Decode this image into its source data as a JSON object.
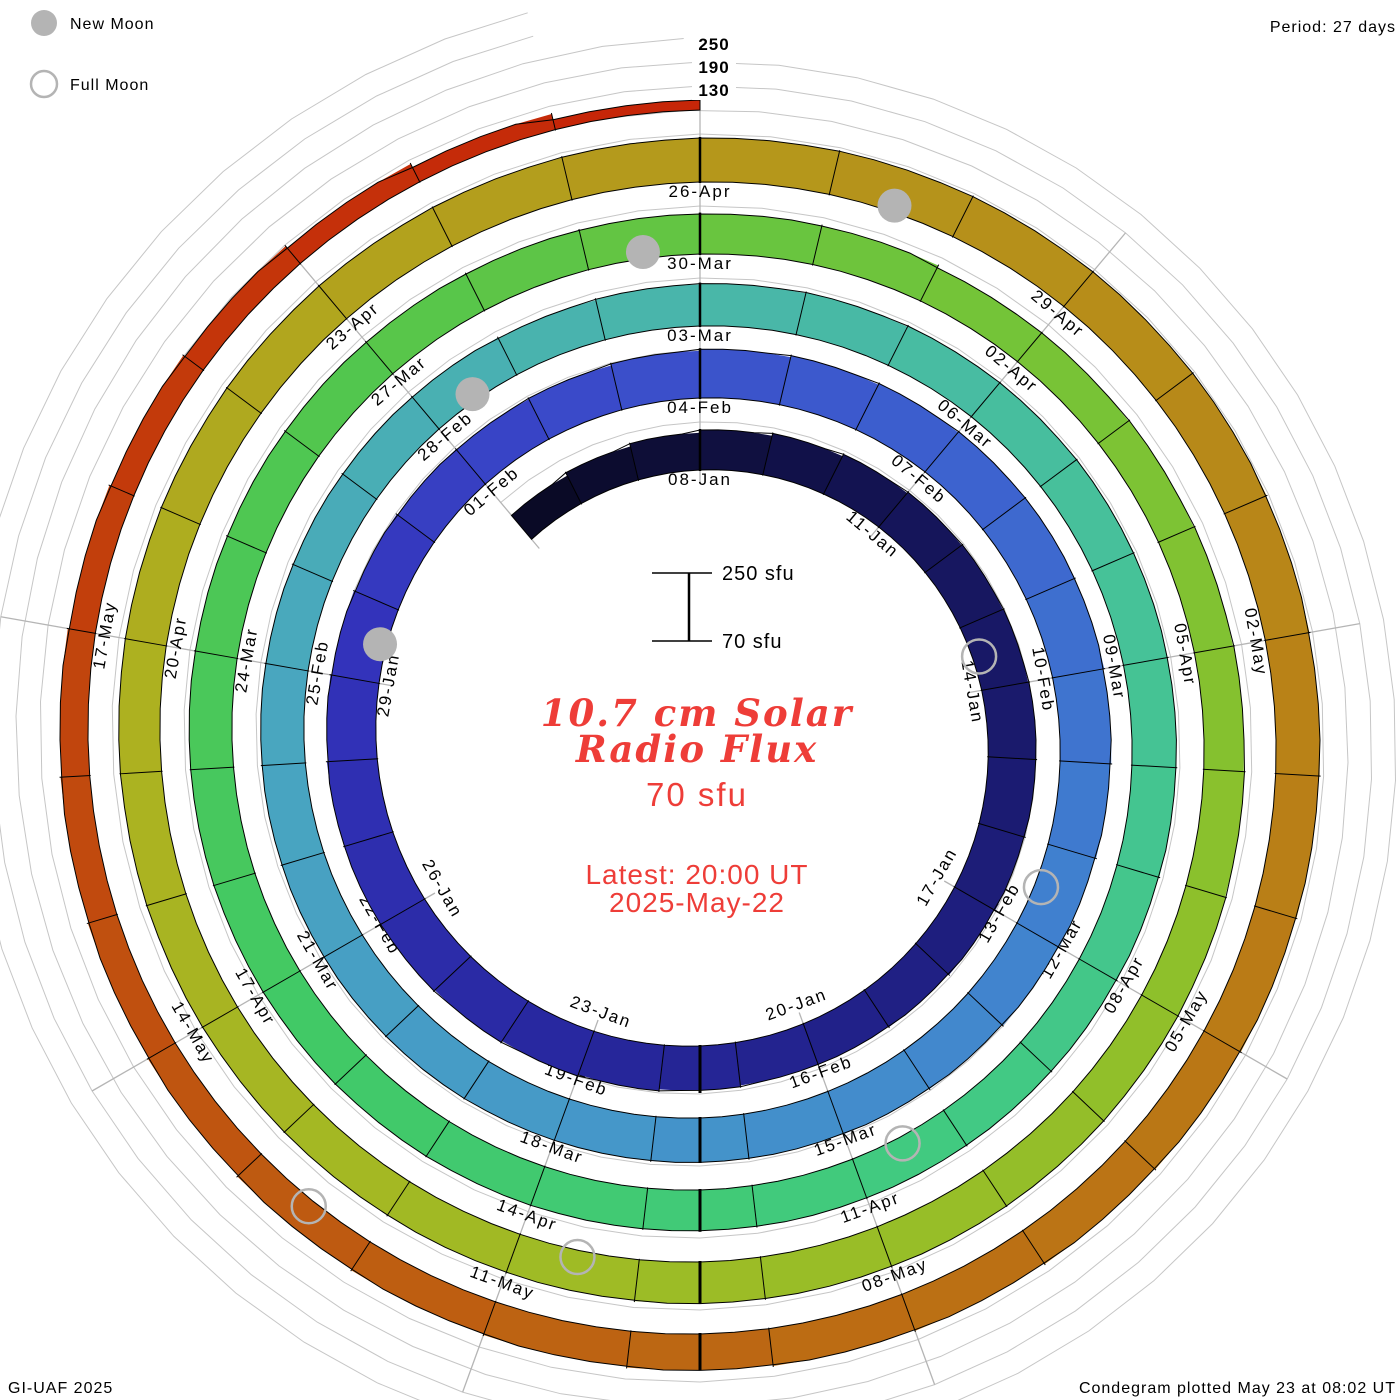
{
  "header": {
    "legend": [
      {
        "label": "New Moon",
        "type": "filled"
      },
      {
        "label": "Full Moon",
        "type": "open"
      }
    ],
    "period_label": "Period: 27 days"
  },
  "radial_axis": {
    "labels": [
      "250",
      "190",
      "130"
    ]
  },
  "center": {
    "scale_top": "250 sfu",
    "scale_bottom": "70 sfu",
    "title_line1": "10.7 cm Solar",
    "title_line2": "Radio Flux",
    "current_value": "70 sfu",
    "latest_line1": "Latest: 20:00 UT",
    "latest_line2": "2025-May-22"
  },
  "footer": {
    "left": "GI-UAF 2025",
    "right": "Condegram plotted May 23 at 08:02 UT"
  },
  "colors": {
    "accent_red_text": "#ee3d38",
    "gridline": "#c6c6c6",
    "spoke": "#b5b5b5",
    "moon_gray": "#b4b4b4",
    "outline": "#000000"
  },
  "chart_data": {
    "type": "bar",
    "subtype": "condegram-polar-spiral",
    "title": "10.7 cm Solar Radio Flux",
    "start_date": "2025-01-05",
    "end_date": "2025-05-22",
    "period_days": 27,
    "baseline_sfu": 70,
    "gridlines_sfu": [
      130,
      190,
      250
    ],
    "scale_bar": {
      "top": "250 sfu",
      "bottom": "70 sfu"
    },
    "latest_value_sfu": 70,
    "latest_time": "20:00 UT 2025-May-22",
    "date_labels": [
      "08-Jan",
      "11-Jan",
      "14-Jan",
      "17-Jan",
      "20-Jan",
      "23-Jan",
      "26-Jan",
      "29-Jan",
      "01-Feb",
      "04-Feb",
      "07-Feb",
      "10-Feb",
      "13-Feb",
      "16-Feb",
      "19-Feb",
      "22-Feb",
      "25-Feb",
      "28-Feb",
      "03-Mar",
      "06-Mar",
      "09-Mar",
      "12-Mar",
      "15-Mar",
      "18-Mar",
      "21-Mar",
      "24-Mar",
      "27-Mar",
      "30-Mar",
      "02-Apr",
      "05-Apr",
      "08-Apr",
      "11-Apr",
      "14-Apr",
      "17-Apr",
      "20-Apr",
      "23-Apr",
      "26-Apr",
      "29-Apr",
      "02-May",
      "05-May",
      "08-May",
      "11-May",
      "14-May",
      "17-May"
    ],
    "values": [
      148,
      156,
      163,
      170,
      176,
      181,
      184,
      186,
      188,
      190,
      189,
      187,
      184,
      181,
      179,
      178,
      181,
      185,
      189,
      193,
      196,
      197,
      196,
      193,
      190,
      187,
      184,
      182,
      184,
      188,
      192,
      196,
      199,
      201,
      202,
      201,
      198,
      195,
      192,
      189,
      186,
      184,
      182,
      181,
      180,
      180,
      181,
      181,
      180,
      179,
      178,
      177,
      176,
      175,
      174,
      172,
      174,
      176,
      178,
      180,
      181,
      182,
      182,
      181,
      180,
      178,
      176,
      175,
      174,
      173,
      172,
      172,
      173,
      174,
      175,
      176,
      177,
      177,
      176,
      175,
      174,
      173,
      172,
      171,
      170,
      169,
      163,
      164,
      166,
      168,
      170,
      172,
      174,
      175,
      176,
      176,
      175,
      174,
      172,
      171,
      170,
      170,
      171,
      172,
      173,
      174,
      175,
      176,
      177,
      178,
      179,
      180,
      181,
      182,
      183,
      184,
      182,
      180,
      178,
      176,
      173,
      170,
      167,
      164,
      161,
      158,
      155,
      152,
      149,
      146,
      143,
      140,
      136,
      132,
      127,
      120,
      110,
      95
    ],
    "moons": {
      "new": [
        {
          "date": "29-Jan",
          "day_index": 24
        },
        {
          "date": "28-Feb",
          "day_index": 54
        },
        {
          "date": "29-Mar",
          "day_index": 83
        },
        {
          "date": "27-Apr",
          "day_index": 112
        }
      ],
      "full": [
        {
          "date": "13-Jan",
          "day_index": 8
        },
        {
          "date": "12-Feb",
          "day_index": 38
        },
        {
          "date": "14-Mar",
          "day_index": 68
        },
        {
          "date": "13-Apr",
          "day_index": 98
        },
        {
          "date": "12-May",
          "day_index": 127
        }
      ]
    },
    "colormap": [
      {
        "at": 0,
        "color": "#0a0a26"
      },
      {
        "at": 6,
        "color": "#15155a"
      },
      {
        "at": 12,
        "color": "#1e1e7e"
      },
      {
        "at": 18,
        "color": "#2828a0"
      },
      {
        "at": 24,
        "color": "#3333bb"
      },
      {
        "at": 28,
        "color": "#3a4ac9"
      },
      {
        "at": 33,
        "color": "#3d63cf"
      },
      {
        "at": 38,
        "color": "#4080cf"
      },
      {
        "at": 44,
        "color": "#4597c9"
      },
      {
        "at": 50,
        "color": "#49a6bf"
      },
      {
        "at": 56,
        "color": "#49b5ab"
      },
      {
        "at": 62,
        "color": "#46c298"
      },
      {
        "at": 68,
        "color": "#41ca80"
      },
      {
        "at": 74,
        "color": "#41c966"
      },
      {
        "at": 80,
        "color": "#52c64e"
      },
      {
        "at": 86,
        "color": "#74c438"
      },
      {
        "at": 92,
        "color": "#8ec02b"
      },
      {
        "at": 98,
        "color": "#9fbb25"
      },
      {
        "at": 104,
        "color": "#adb120"
      },
      {
        "at": 110,
        "color": "#b49a1c"
      },
      {
        "at": 116,
        "color": "#b88618"
      },
      {
        "at": 122,
        "color": "#bb7014"
      },
      {
        "at": 128,
        "color": "#bf5510"
      },
      {
        "at": 133,
        "color": "#c33a0b"
      },
      {
        "at": 137,
        "color": "#c62608"
      }
    ],
    "layout_hints": {
      "grid": true,
      "direction": "clockwise",
      "top_angle_date": "08-Jan",
      "spokes_every_days": 3
    }
  }
}
